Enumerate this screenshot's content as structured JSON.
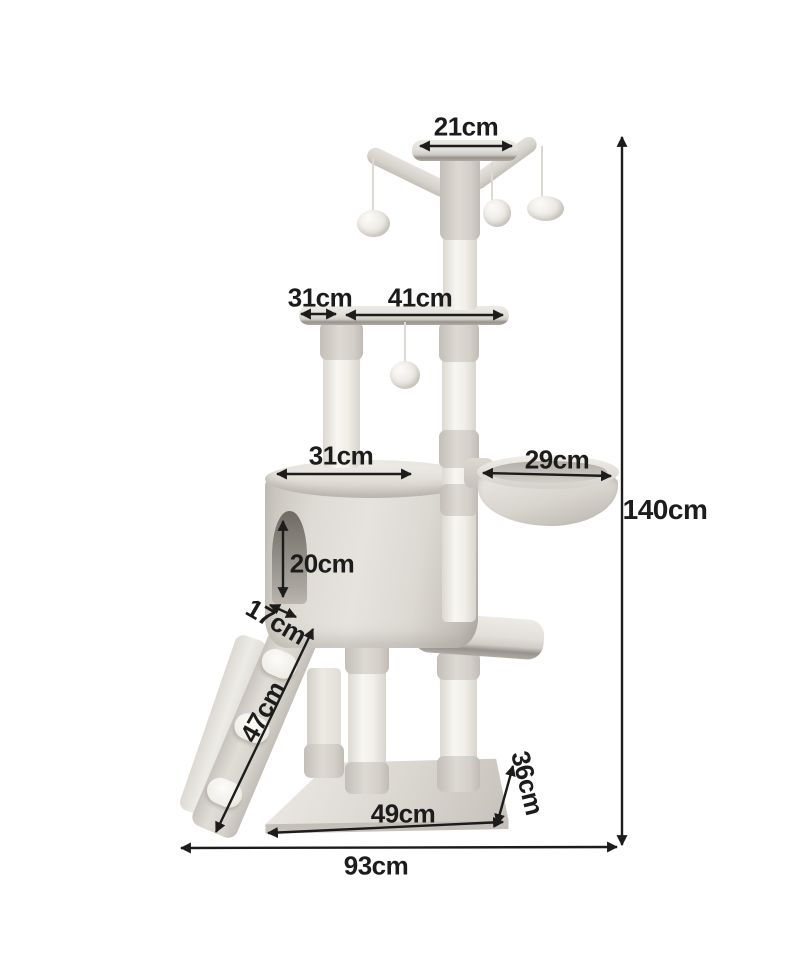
{
  "page": {
    "background": "#ffffff",
    "subject": "cat tree dimension diagram"
  },
  "colors": {
    "ink": "#1c1c1c",
    "plush": "#dbd8d2",
    "post_white": "#f4f2ed",
    "edge_shadow": "#97938c"
  },
  "labels": {
    "top_platform": "21cm",
    "upper_platform_left": "31cm",
    "upper_platform_main": "41cm",
    "condo_width": "31cm",
    "basket_width": "29cm",
    "entrance_height": "20cm",
    "ramp_depth": "17cm",
    "ramp_length": "47cm",
    "total_height": "140cm",
    "base_depth": "36cm",
    "base_front_width": "49cm",
    "total_width": "93cm"
  }
}
